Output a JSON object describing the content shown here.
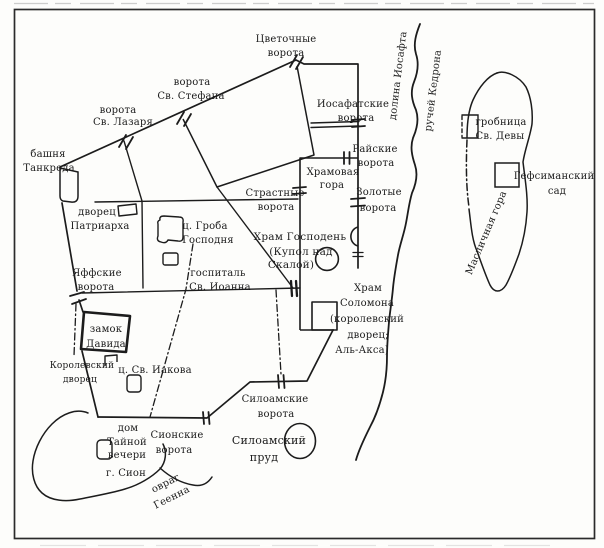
{
  "map": {
    "kind": "scanned schematic map of medieval Jerusalem",
    "colors": {
      "ink": "#1c1c1c",
      "paper": "#fdfdfb",
      "frame": "#2b2b2b"
    },
    "labels": {
      "flower_gate": {
        "line1": "Цветочные",
        "line2": "ворота"
      },
      "stephen_gate": {
        "line1": "ворота",
        "line2": "Св. Стефана"
      },
      "lazarus_gate": {
        "line1": "ворота",
        "line2": "Св. Лазаря"
      },
      "tancred_tower": {
        "line1": "башня",
        "line2": "Танкреда"
      },
      "patriarch_palace": {
        "line1": "дворец",
        "line2": "Патриарха"
      },
      "holy_sepulchre": {
        "line1": "ц. Гроба",
        "line2": "Господня"
      },
      "hospital": {
        "line1": "госпиталь",
        "line2": "Св. Иоанна"
      },
      "jaffa_gate": {
        "line1": "Яффские",
        "line2": "ворота"
      },
      "passion_gate": {
        "line1": "Страстные",
        "line2": "ворота"
      },
      "josaphat_gate": {
        "line1": "Иосафатские",
        "line2": "ворота"
      },
      "paradise_gate": {
        "line1": "Райские",
        "line2": "ворота"
      },
      "golden_gate": {
        "line1": "Золотые",
        "line2": "ворота"
      },
      "temple_mount": {
        "line1": "Храмовая",
        "line2": "гора"
      },
      "temple_of_lord": {
        "line1": "Храм Господень",
        "line2": "(Купол над",
        "line3": "Скалой)"
      },
      "solomon_temple": {
        "line1": "Храм",
        "line2": "Соломона",
        "line3": "(королевский",
        "line4": "дворец;",
        "line5": "Аль-Акса)"
      },
      "david_castle": {
        "line1": "замок",
        "line2": "Давида"
      },
      "royal_palace": {
        "line1": "Королевский",
        "line2": "дворец"
      },
      "st_james": {
        "line1": "ц. Св. Иакова"
      },
      "last_supper": {
        "line1": "дом",
        "line2": "Тайной",
        "line3": "вечери"
      },
      "mount_zion": {
        "line1": "г. Сион"
      },
      "zion_gate": {
        "line1": "Сионские",
        "line2": "ворота"
      },
      "siloam_gate": {
        "line1": "Силоамские",
        "line2": "ворота"
      },
      "siloam_pool": {
        "line1": "Силоамский",
        "line2": "пруд"
      },
      "gehenna_ravine": {
        "line1": "овраг",
        "line2": "Геенна"
      },
      "josaphat_valley": {
        "line1": "долина Иосафта"
      },
      "kidron_brook": {
        "line1": "ручей Кедрона"
      },
      "virgin_tomb": {
        "line1": "гробница",
        "line2": "Св. Девы"
      },
      "gethsemane": {
        "line1": "Гефсиманский",
        "line2": "сад"
      },
      "mount_of_olives": {
        "line1": "Масличная гора"
      }
    }
  }
}
